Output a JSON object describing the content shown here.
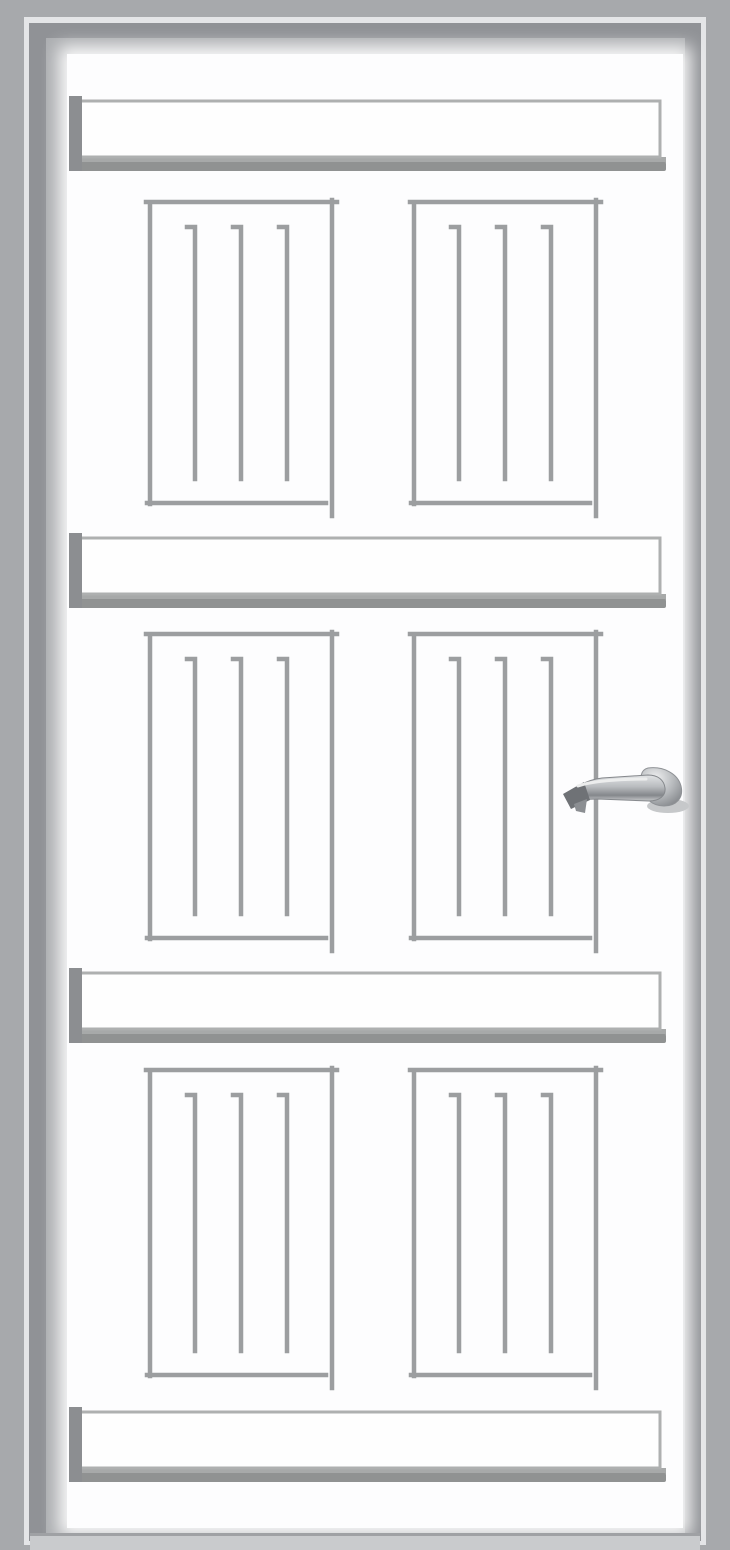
{
  "scene": {
    "description": "Front view of a closed white six-panel door inside a grey metal frame, with a chrome lever handle on the right side",
    "subject": "white paneled door",
    "visible_text": "none"
  },
  "palette": {
    "frame_outer": "#a7a9ac",
    "frame_trim_highlight": "#e4e5e7",
    "frame_inner_band": "#909296",
    "frame_bevel": "#acaeb1",
    "door_surface": "#fdfdfe",
    "panel_outline": "#9c9ea0",
    "rail_fill": "#fefefe",
    "rail_border": "#aeb0b0",
    "rail_shadow_light": "#a7a9a9",
    "rail_shadow_dark": "#909292",
    "rail_end_cap": "#8c8e91",
    "threshold": "#c9cbcd",
    "handle_dark": "#6f7276",
    "handle_mid": "#9a9da1",
    "handle_light": "#dcdee0"
  },
  "door": {
    "style": "six recessed grooved panels separated by four raised horizontal rails",
    "rails": {
      "count": 4,
      "x_start": 70,
      "x_end": 660,
      "top_edges_y": [
        101,
        538,
        973,
        1412
      ],
      "white_height": 56
    },
    "panels": {
      "rows": 3,
      "columns": 2,
      "row_top_y": [
        200,
        632,
        1068
      ],
      "row_heights": [
        303,
        306,
        307
      ],
      "column_left_x": [
        148,
        412
      ],
      "width": 182,
      "grooves_per_panel": 3,
      "groove_spacing": 46
    },
    "handle": {
      "type": "lever",
      "finish": "chrome",
      "points": "left",
      "side": "right",
      "x": 563,
      "y": 755,
      "width": 127,
      "height": 60
    }
  }
}
